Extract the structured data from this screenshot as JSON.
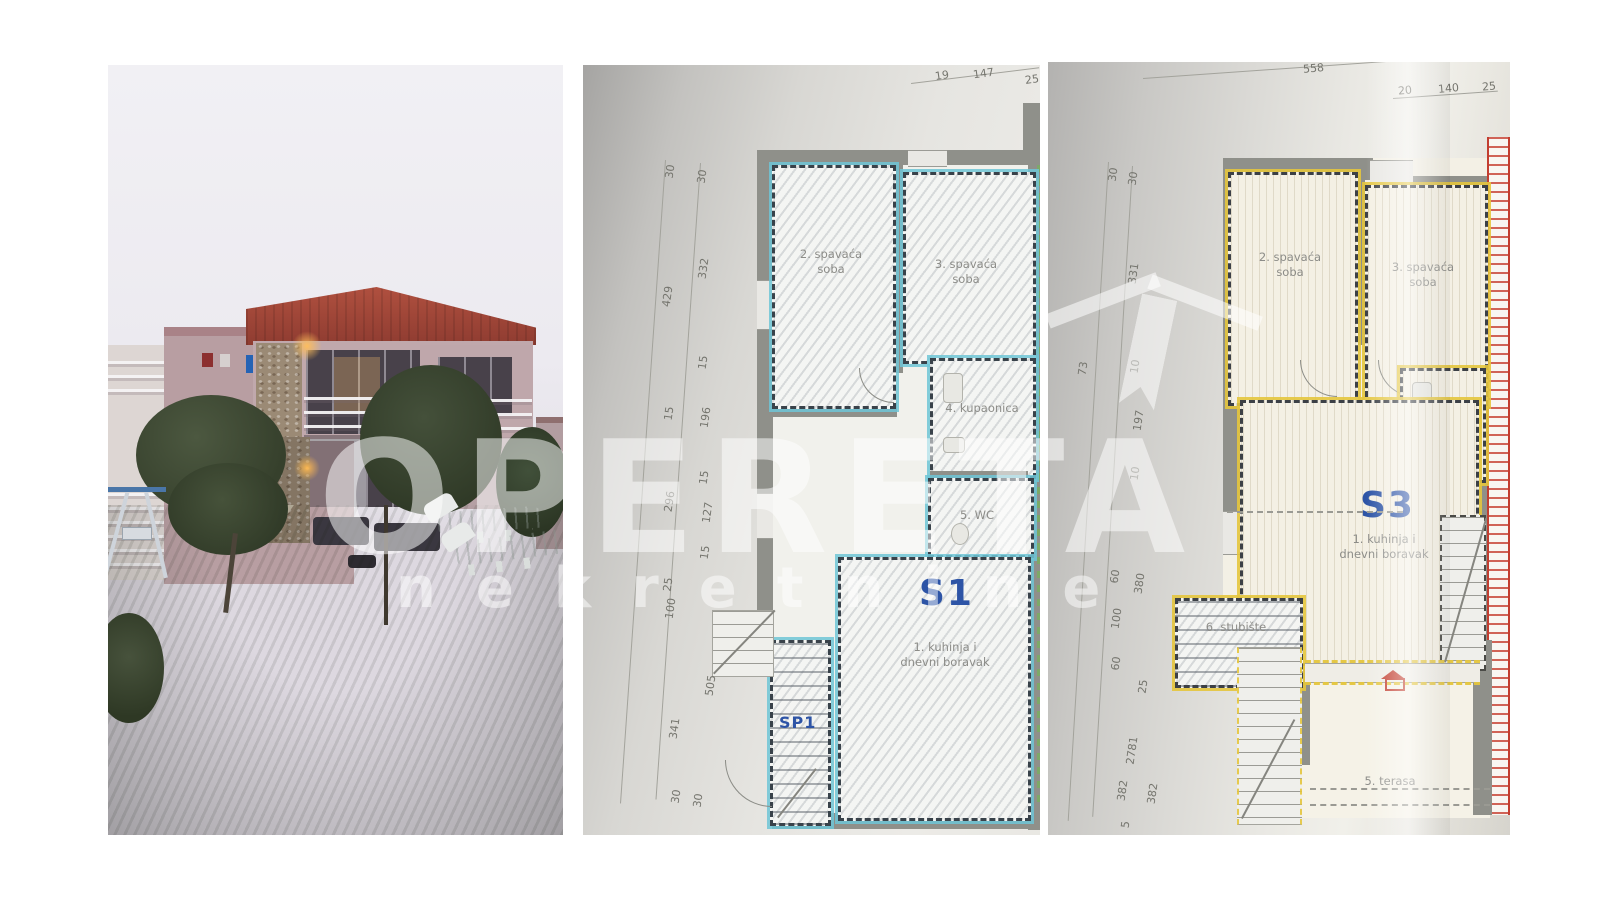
{
  "watermark": {
    "brand": "OPERETA",
    "tagline": "nekretnine"
  },
  "plan1": {
    "unit": "S1",
    "stair_unit": "SP1",
    "rooms": {
      "bedroom2_line1": "2. spavaća",
      "bedroom2_line2": "soba",
      "bedroom3_line1": "3. spavaća",
      "bedroom3_line2": "soba",
      "bathroom": "4. kupaonica",
      "wc": "5. WC",
      "kitchen_line1": "1. kuhinja i",
      "kitchen_line2": "dnevni boravak"
    },
    "dims": {
      "top": [
        "19",
        "147",
        "25"
      ],
      "left_outer": [
        "30",
        "429",
        "15",
        "296",
        "25",
        "100",
        "341"
      ],
      "left_inner": [
        "30",
        "332",
        "15",
        "196",
        "15",
        "127",
        "15",
        "505"
      ],
      "bottom": [
        "30",
        "30"
      ]
    }
  },
  "plan2": {
    "unit": "S3",
    "rooms": {
      "bedroom2_line1": "2. spavaća",
      "bedroom2_line2": "soba",
      "bedroom3_line1": "3. spavaća",
      "bedroom3_line2": "soba",
      "bathroom": "4. kupaonica",
      "kitchen_line1": "1. kuhinja i",
      "kitchen_line2": "dnevni boravak",
      "stairs": "6. stubište",
      "terrace": "5. terasa"
    },
    "dims": {
      "top": [
        "558",
        "20",
        "140",
        "25"
      ],
      "left_outer": [
        "30",
        "73",
        "60",
        "100",
        "60",
        "2781",
        "382",
        "5"
      ],
      "left_inner": [
        "30",
        "331",
        "10",
        "197",
        "10",
        "380",
        "25",
        "382"
      ]
    }
  },
  "colors": {
    "plan1_accent": "#6fc5d6",
    "plan2_accent": "#e4c53d",
    "unit_label_blue": "#2d54a6",
    "red_accent": "#c23e30",
    "wall_gray": "#8f908a",
    "watermark_white": "rgba(255,255,255,0.52)"
  }
}
